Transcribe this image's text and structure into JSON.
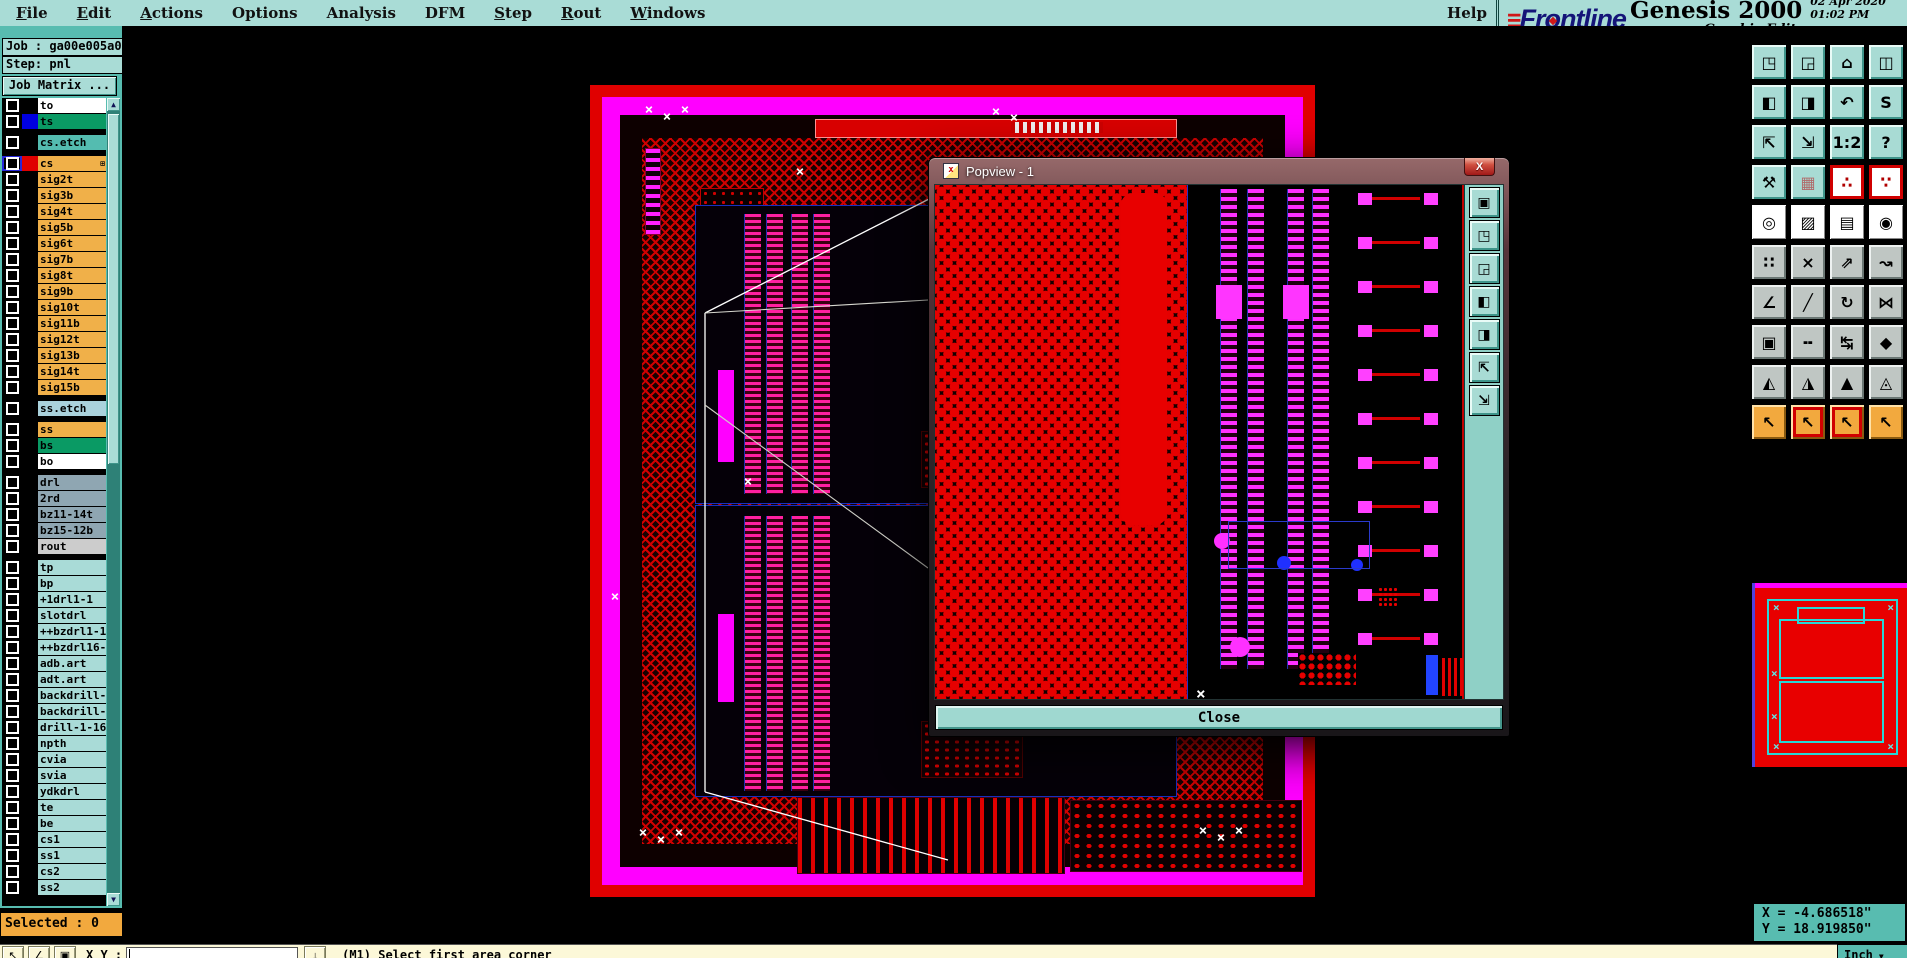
{
  "menu": {
    "items": [
      {
        "label": "File",
        "u": 0
      },
      {
        "label": "Edit",
        "u": 0
      },
      {
        "label": "Actions",
        "u": 0
      },
      {
        "label": "Options",
        "u": -1
      },
      {
        "label": "Analysis",
        "u": -1
      },
      {
        "label": "DFM",
        "u": -1
      },
      {
        "label": "Step",
        "u": 0
      },
      {
        "label": "Rout",
        "u": 0
      },
      {
        "label": "Windows",
        "u": 0
      }
    ],
    "help": {
      "label": "Help",
      "u": -1
    }
  },
  "brand": {
    "logo_speed": "≡",
    "logo_pre": "Fr",
    "logo_o": "o",
    "logo_post": "ntline",
    "product": "Genesis 2000",
    "date": "02 Apr 2020",
    "time": "01:02 PM",
    "subtitle": "Graphic Editor"
  },
  "sidebar": {
    "job": "Job : ga00e005a0",
    "step": "Step: pnl",
    "job_matrix": "Job Matrix ...",
    "selected": "Selected : 0",
    "layers": [
      {
        "label": "to",
        "bg": "#ffffff",
        "sw": "#000000",
        "cls2": ""
      },
      {
        "label": "ts",
        "bg": "#0a9a64",
        "sw": "#0000e0",
        "cls2": ""
      },
      {
        "cls2": "sep"
      },
      {
        "label": "cs.etch",
        "bg": "#54bcb0",
        "sw": "#000000",
        "cls2": ""
      },
      {
        "cls2": "sep"
      },
      {
        "label": "cs",
        "bg": "#f0b049",
        "sw": "#e00000",
        "cls2": "selrow",
        "badge": "⊞"
      },
      {
        "label": "sig2t",
        "bg": "#f0b049",
        "sw": "#000000",
        "cls2": ""
      },
      {
        "label": "sig3b",
        "bg": "#f0b049",
        "sw": "#000000",
        "cls2": ""
      },
      {
        "label": "sig4t",
        "bg": "#f0b049",
        "sw": "#000000",
        "cls2": ""
      },
      {
        "label": "sig5b",
        "bg": "#f0b049",
        "sw": "#000000",
        "cls2": ""
      },
      {
        "label": "sig6t",
        "bg": "#f0b049",
        "sw": "#000000",
        "cls2": ""
      },
      {
        "label": "sig7b",
        "bg": "#f0b049",
        "sw": "#000000",
        "cls2": ""
      },
      {
        "label": "sig8t",
        "bg": "#f0b049",
        "sw": "#000000",
        "cls2": ""
      },
      {
        "label": "sig9b",
        "bg": "#f0b049",
        "sw": "#000000",
        "cls2": ""
      },
      {
        "label": "sig10t",
        "bg": "#f0b049",
        "sw": "#000000",
        "cls2": ""
      },
      {
        "label": "sig11b",
        "bg": "#f0b049",
        "sw": "#000000",
        "cls2": ""
      },
      {
        "label": "sig12t",
        "bg": "#f0b049",
        "sw": "#000000",
        "cls2": ""
      },
      {
        "label": "sig13b",
        "bg": "#f0b049",
        "sw": "#000000",
        "cls2": ""
      },
      {
        "label": "sig14t",
        "bg": "#f0b049",
        "sw": "#000000",
        "cls2": ""
      },
      {
        "label": "sig15b",
        "bg": "#f0b049",
        "sw": "#000000",
        "cls2": ""
      },
      {
        "cls2": "sep"
      },
      {
        "label": "ss.etch",
        "bg": "#aad2dc",
        "sw": "#000000",
        "cls2": ""
      },
      {
        "cls2": "sep"
      },
      {
        "label": "ss",
        "bg": "#f0b049",
        "sw": "#000000",
        "cls2": ""
      },
      {
        "label": "bs",
        "bg": "#0a9a64",
        "sw": "#000000",
        "cls2": ""
      },
      {
        "label": "bo",
        "bg": "#ffffff",
        "sw": "#000000",
        "cls2": ""
      },
      {
        "cls2": "sep"
      },
      {
        "label": "drl",
        "bg": "#8fa6b2",
        "sw": "#000000",
        "cls2": ""
      },
      {
        "label": "2rd",
        "bg": "#8fa6b2",
        "sw": "#000000",
        "cls2": ""
      },
      {
        "label": "bz11-14t",
        "bg": "#8fa6b2",
        "sw": "#000000",
        "cls2": ""
      },
      {
        "label": "bz15-12b",
        "bg": "#8fa6b2",
        "sw": "#000000",
        "cls2": ""
      },
      {
        "label": "rout",
        "bg": "#cccccc",
        "sw": "#000000",
        "cls2": ""
      },
      {
        "cls2": "sep"
      },
      {
        "label": "tp",
        "bg": "#a9dbd7",
        "sw": "#000000",
        "cls2": ""
      },
      {
        "label": "bp",
        "bg": "#a9dbd7",
        "sw": "#000000",
        "cls2": ""
      },
      {
        "label": "+1drl1-1",
        "bg": "#a9dbd7",
        "sw": "#000000",
        "cls2": ""
      },
      {
        "label": "slotdrl",
        "bg": "#a9dbd7",
        "sw": "#000000",
        "cls2": ""
      },
      {
        "label": "++bzdrl1-13",
        "bg": "#a9dbd7",
        "sw": "#000000",
        "cls2": ""
      },
      {
        "label": "++bzdrl16-13",
        "bg": "#a9dbd7",
        "sw": "#000000",
        "cls2": ""
      },
      {
        "label": "adb.art",
        "bg": "#a9dbd7",
        "sw": "#000000",
        "cls2": ""
      },
      {
        "label": "adt.art",
        "bg": "#a9dbd7",
        "sw": "#000000",
        "cls2": ""
      },
      {
        "label": "backdrill-1-1",
        "bg": "#a9dbd7",
        "sw": "#000000",
        "cls2": ""
      },
      {
        "label": "backdrill-16",
        "bg": "#a9dbd7",
        "sw": "#000000",
        "cls2": ""
      },
      {
        "label": "drill-1-16",
        "bg": "#a9dbd7",
        "sw": "#000000",
        "cls2": ""
      },
      {
        "label": "npth",
        "bg": "#a9dbd7",
        "sw": "#000000",
        "cls2": ""
      },
      {
        "label": "cvia",
        "bg": "#a9dbd7",
        "sw": "#000000",
        "cls2": ""
      },
      {
        "label": "svia",
        "bg": "#a9dbd7",
        "sw": "#000000",
        "cls2": ""
      },
      {
        "label": "ydkdrl",
        "bg": "#a9dbd7",
        "sw": "#000000",
        "cls2": ""
      },
      {
        "label": "te",
        "bg": "#a9dbd7",
        "sw": "#000000",
        "cls2": ""
      },
      {
        "label": "be",
        "bg": "#a9dbd7",
        "sw": "#000000",
        "cls2": ""
      },
      {
        "label": "cs1",
        "bg": "#a9dbd7",
        "sw": "#000000",
        "cls2": ""
      },
      {
        "label": "ss1",
        "bg": "#a9dbd7",
        "sw": "#000000",
        "cls2": ""
      },
      {
        "label": "cs2",
        "bg": "#a9dbd7",
        "sw": "#000000",
        "cls2": ""
      },
      {
        "label": "ss2",
        "bg": "#a9dbd7",
        "sw": "#000000",
        "cls2": ""
      }
    ]
  },
  "toolbar": {
    "buttons": [
      {
        "name": "zoom-in-button",
        "glyph": "◳",
        "cls": "t"
      },
      {
        "name": "zoom-out-button",
        "glyph": "◲",
        "cls": "t"
      },
      {
        "name": "home-view-button",
        "glyph": "⌂",
        "cls": "t"
      },
      {
        "name": "split-view-xy-button",
        "glyph": "◫",
        "cls": "t"
      },
      {
        "name": "pan-left-button",
        "glyph": "◧",
        "cls": "t"
      },
      {
        "name": "pan-right-button",
        "glyph": "◨",
        "cls": "t"
      },
      {
        "name": "previous-view-button",
        "glyph": "↶",
        "cls": "t"
      },
      {
        "name": "s-route-button",
        "glyph": "S",
        "cls": "t"
      },
      {
        "name": "zoom-extents-button",
        "glyph": "⇱",
        "cls": "t"
      },
      {
        "name": "zoom-center-button",
        "glyph": "⇲",
        "cls": "t"
      },
      {
        "name": "scale-1-2-button",
        "glyph": "1:2",
        "cls": "t"
      },
      {
        "name": "query-button",
        "glyph": "?",
        "cls": "t"
      },
      {
        "name": "setup-tools-button",
        "glyph": "⚒",
        "cls": "t"
      },
      {
        "name": "grid-toggle-button",
        "glyph": "▦",
        "cls": "t grid"
      },
      {
        "name": "net-highlight-button",
        "glyph": "∴",
        "cls": "w rb"
      },
      {
        "name": "net-highlight-alt-button",
        "glyph": "∵",
        "cls": "w rb"
      },
      {
        "name": "select-symbol-button",
        "glyph": "◎",
        "cls": "w"
      },
      {
        "name": "reshape-symbol-button",
        "glyph": "▨",
        "cls": "w"
      },
      {
        "name": "ruler-button",
        "glyph": "▤",
        "cls": "w"
      },
      {
        "name": "select-pad-button",
        "glyph": "◉",
        "cls": "w"
      },
      {
        "name": "connect-points-button",
        "glyph": "∷",
        "cls": "g"
      },
      {
        "name": "delete-object-button",
        "glyph": "×",
        "cls": "g"
      },
      {
        "name": "point-to-point-button",
        "glyph": "⇗",
        "cls": "g"
      },
      {
        "name": "snap-point-button",
        "glyph": "↝",
        "cls": "g"
      },
      {
        "name": "angle-tool-button",
        "glyph": "∠",
        "cls": "g"
      },
      {
        "name": "slope-line-button",
        "glyph": "╱",
        "cls": "g"
      },
      {
        "name": "rotate-tool-button",
        "glyph": "↻",
        "cls": "g"
      },
      {
        "name": "mirror-tool-button",
        "glyph": "⋈",
        "cls": "g"
      },
      {
        "name": "copy-pad-button",
        "glyph": "▣",
        "cls": "g"
      },
      {
        "name": "break-line-button",
        "glyph": "╍",
        "cls": "g"
      },
      {
        "name": "measure-distance-button",
        "glyph": "↹",
        "cls": "g"
      },
      {
        "name": "merge-shapes-button",
        "glyph": "◆",
        "cls": "g"
      },
      {
        "name": "triangle-open-button",
        "glyph": "◭",
        "cls": "g"
      },
      {
        "name": "triangle-outline-button",
        "glyph": "◮",
        "cls": "g"
      },
      {
        "name": "triangle-filled-button",
        "glyph": "▲",
        "cls": "g"
      },
      {
        "name": "triangle-wide-button",
        "glyph": "◬",
        "cls": "g"
      },
      {
        "name": "select-mode-button",
        "glyph": "↖",
        "cls": "o"
      },
      {
        "name": "frame-select-button",
        "glyph": "↖",
        "cls": "o ri"
      },
      {
        "name": "polygon-select-button",
        "glyph": "↖",
        "cls": "o ri"
      },
      {
        "name": "net-select-button",
        "glyph": "↖",
        "cls": "o"
      }
    ]
  },
  "popup": {
    "title": "Popview - 1",
    "icon_glyph": "x",
    "close_glyph": "X",
    "close": "Close",
    "side_buttons": [
      {
        "name": "popview-clone-button",
        "glyph": "▣"
      },
      {
        "name": "popview-zoom-in-button",
        "glyph": "◳"
      },
      {
        "name": "popview-zoom-out-button",
        "glyph": "◲"
      },
      {
        "name": "popview-pan-left-button",
        "glyph": "◧"
      },
      {
        "name": "popview-pan-right-button",
        "glyph": "◨"
      },
      {
        "name": "popview-zoom-extents-button",
        "glyph": "⇱"
      },
      {
        "name": "popview-zoom-center-button",
        "glyph": "⇲"
      }
    ]
  },
  "statusbar": {
    "buttons": [
      {
        "name": "pointer-mode-button",
        "glyph": "↖"
      },
      {
        "name": "angle-mode-button",
        "glyph": "∠"
      },
      {
        "name": "window-mode-button",
        "glyph": "▣"
      }
    ],
    "xy_label": "X Y :",
    "input_value": "",
    "entry_button_glyph": "↓",
    "message": "(M1)  Select first area corner",
    "units": "Inch"
  },
  "coords": {
    "x": "X = -4.686518\"",
    "y": "Y = 18.919850\""
  },
  "colors": {
    "menu_teal": "#a9dcd6",
    "panel_teal": "#58bcb0",
    "button_teal": "#a8dbd4",
    "layer_orange": "#f0b049",
    "layer_green": "#0a9a64",
    "layer_slate": "#8fa6b2",
    "layer_lightteal": "#a9dbd7",
    "selected_orange": "#f2a93e",
    "statusbar_cream": "#fcf8d8",
    "pcb_red": "#e00000",
    "pcb_magenta": "#ff00ff",
    "logo_blue": "#141478",
    "logo_red": "#d01818"
  }
}
